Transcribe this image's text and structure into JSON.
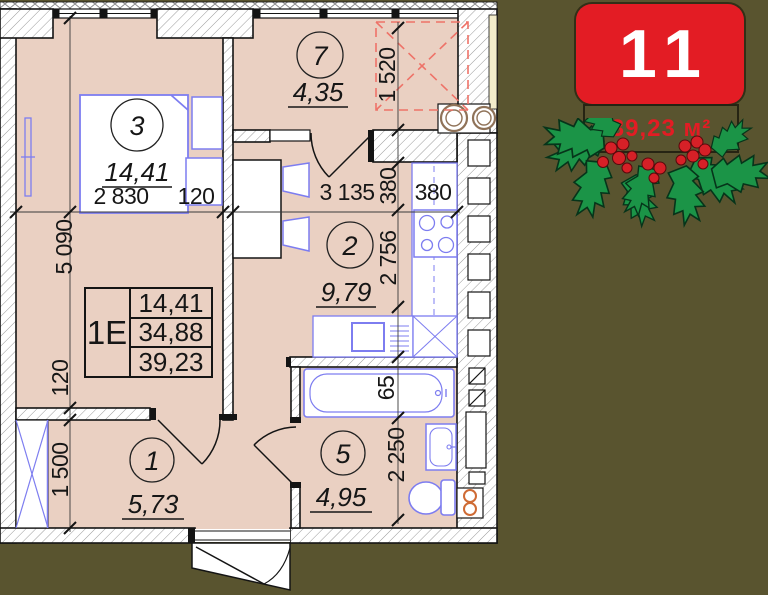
{
  "badge": {
    "number": "11",
    "area_label": "39,23 м²"
  },
  "plan": {
    "rooms": [
      {
        "num": "3",
        "area": "14,41"
      },
      {
        "num": "7",
        "area": "4,35"
      },
      {
        "num": "2",
        "area": "9,79"
      },
      {
        "num": "1",
        "area": "5,73"
      },
      {
        "num": "5",
        "area": "4,95"
      }
    ],
    "table": {
      "type": "1E",
      "rows": [
        "14,41",
        "34,88",
        "39,23"
      ]
    },
    "dims": {
      "h_total": "5 090",
      "wall_120_left": "120",
      "closet": "1 500",
      "room3_width": "2 830",
      "wall_120_top": "120",
      "kitchen_width": "3 135",
      "shaft_380_a": "380",
      "shaft_380_b": "380",
      "loggia": "1 520",
      "kitchen_depth": "2 756",
      "bath_65": "65",
      "bath_depth": "2 250"
    }
  },
  "colors": {
    "background": "#59542f",
    "floor": "#ead0c2",
    "wall_line": "#141414",
    "furniture_blue": "#7d7df0",
    "accent_red": "#e31c24",
    "dashed_red": "#ee7268",
    "holly_green": "#1b9447",
    "berry_red": "#d62027",
    "orange_pipes": "#cf6b35"
  }
}
